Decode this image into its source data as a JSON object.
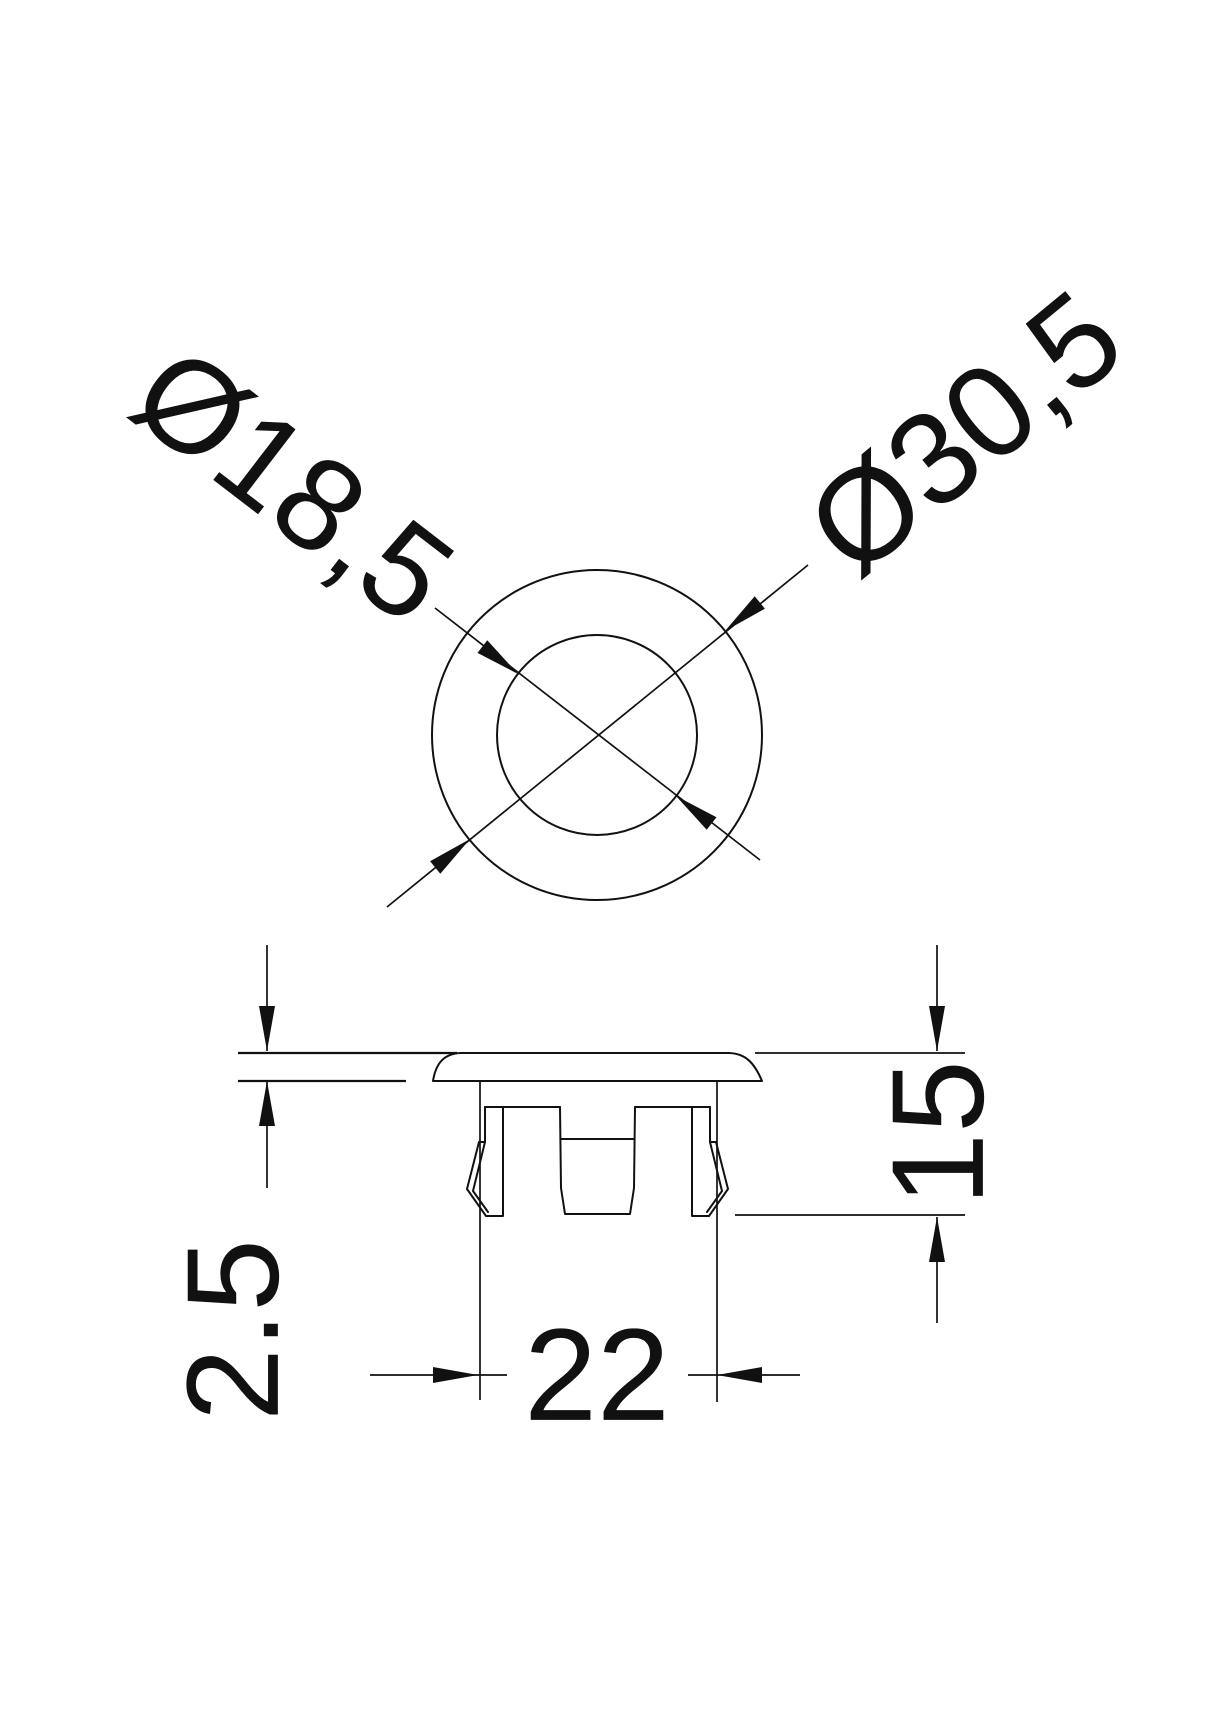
{
  "drawing_type": "technical dimension drawing of a snap-in hole plug (top view and side section)",
  "colors": {
    "line": "#111111",
    "background": "#ffffff"
  },
  "top_view": {
    "inner_diameter": "Ø18,5",
    "outer_diameter": "Ø30,5"
  },
  "side_view": {
    "cap_thickness": "2.5",
    "overall_height": "15",
    "barrel_width": "22"
  }
}
